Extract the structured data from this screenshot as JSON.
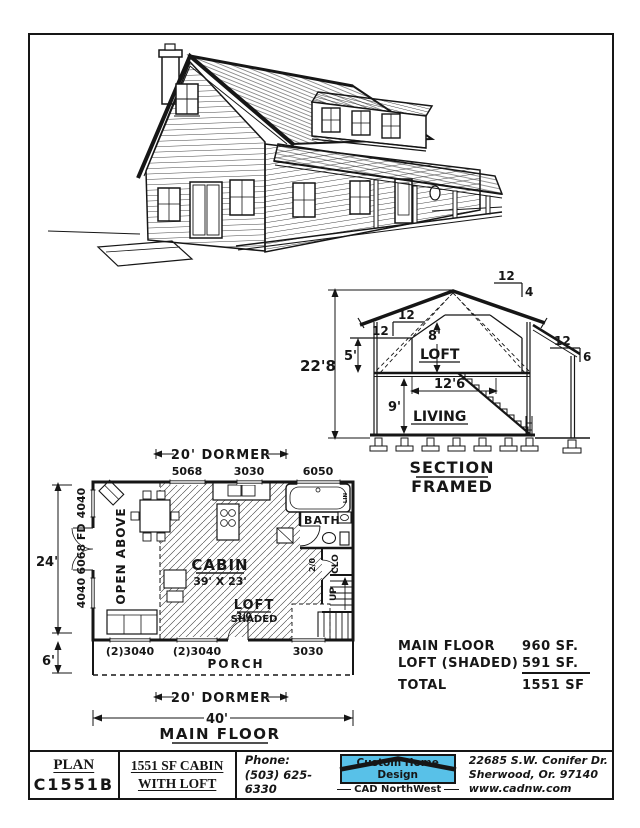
{
  "colors": {
    "ink": "#161616",
    "logo_blue": "#58c1e8"
  },
  "section": {
    "title1": "SECTION",
    "title2": "FRAMED",
    "rooms": {
      "loft": "LOFT",
      "living": "LIVING"
    },
    "dims": {
      "overall": "22'8",
      "kneewall": "5'",
      "loft_h": "8'",
      "loft_w": "12'6",
      "living_h": "9'"
    },
    "pitches": {
      "main_rise": "12",
      "main_run": "12",
      "upper_rise": "12",
      "upper_run": "4",
      "porch_rise": "12",
      "porch_run": "6"
    }
  },
  "plan": {
    "dims": {
      "dormer_top": "20' DORMER",
      "dormer_bottom": "20' DORMER",
      "overall_width": "40'",
      "overall_depth": "24'",
      "porch_depth": "6'"
    },
    "title": "MAIN FLOOR",
    "windows_top": [
      "5068",
      "3030",
      "6050"
    ],
    "windows_left": [
      "4040",
      "6068 FD",
      "4040"
    ],
    "windows_bottom": [
      "(2)3040",
      "(2)3040",
      "3030"
    ],
    "rooms": {
      "open_above": "OPEN ABOVE",
      "cabin": "CABIN",
      "cabin_size": "39' X 23'",
      "loft": "LOFT",
      "loft_shaded": "SHADED",
      "bath": "BATH",
      "clo": "CLO",
      "lin": "LIN",
      "up": "UP",
      "porch": "PORCH",
      "door_front": "3/0",
      "door_bath": "2/0"
    }
  },
  "areas": {
    "rows": [
      {
        "label": "MAIN FLOOR",
        "value": "960 SF."
      },
      {
        "label": "LOFT (SHADED)",
        "value": "591 SF."
      },
      {
        "label": "TOTAL",
        "value": "1551 SF"
      }
    ]
  },
  "title_block": {
    "plan_label": "PLAN",
    "plan_number": "C1551B",
    "title1": "1551 SF CABIN",
    "title2": "WITH LOFT",
    "phone_label": "Phone:",
    "phone": "(503) 625-6330",
    "logo_title": "Custom Home Design",
    "logo_sub": "CAD NorthWest",
    "addr1": "22685 S.W. Conifer Dr.",
    "addr2": "Sherwood, Or. 97140",
    "addr3": "www.cadnw.com"
  }
}
